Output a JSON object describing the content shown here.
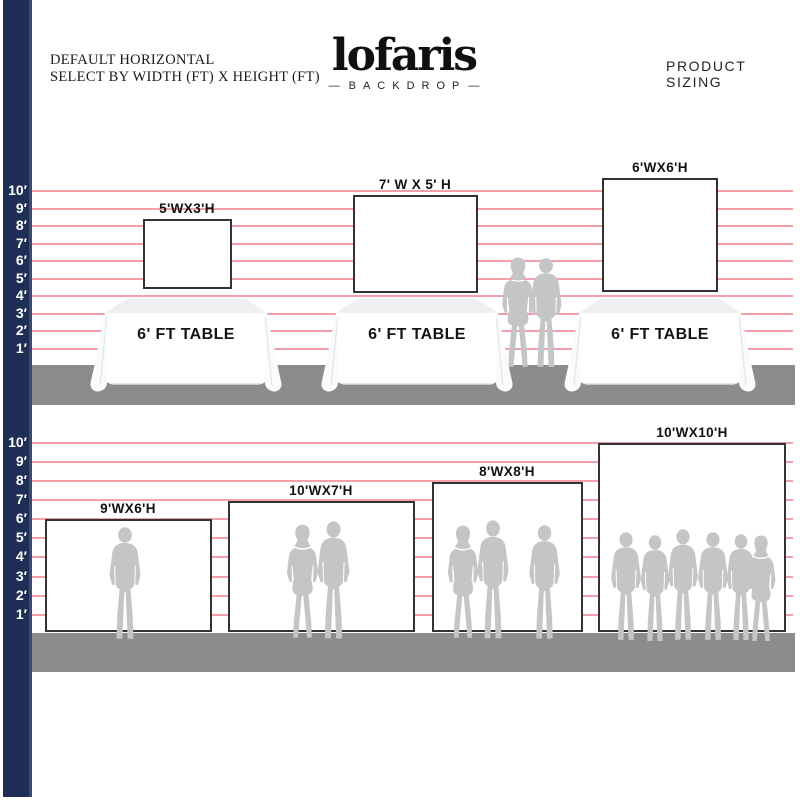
{
  "header": {
    "left": {
      "line1": "DEFAULT HORIZONTAL",
      "line2": "SELECT BY WIDTH (FT) X HEIGHT (FT)"
    },
    "logo": {
      "name": "lofaris",
      "dash": "—",
      "tagline": "BACKDROP"
    },
    "right": "PRODUCT SIZING"
  },
  "ruler": {
    "labels": [
      "10′",
      "9′",
      "8′",
      "7′",
      "6′",
      "5′",
      "4′",
      "3′",
      "2′",
      "1′"
    ]
  },
  "top_section": {
    "table_label": "6' FT TABLE",
    "backdrops": [
      {
        "label": "5'WX3'H",
        "people": 0
      },
      {
        "label": "7' W X 5' H",
        "people": 0
      },
      {
        "label": "6'WX6'H",
        "people": 0
      }
    ],
    "standing_people": 2
  },
  "bottom_section": {
    "backdrops": [
      {
        "label": "9'WX6'H",
        "people": 1
      },
      {
        "label": "10'WX7'H",
        "people": 2
      },
      {
        "label": "8'WX8'H",
        "people": 3
      },
      {
        "label": "10'WX10'H",
        "people": 6
      }
    ]
  },
  "colors": {
    "navy_bar": "#1f2e54",
    "gridline_pink": "#f2a0a9",
    "floor_gray": "#8c8c8c",
    "silhouette_gray": "#c3c5c7",
    "backdrop_border": "#333333"
  },
  "icons": {
    "people": "person-silhouette",
    "table": "tablecloth-table"
  }
}
